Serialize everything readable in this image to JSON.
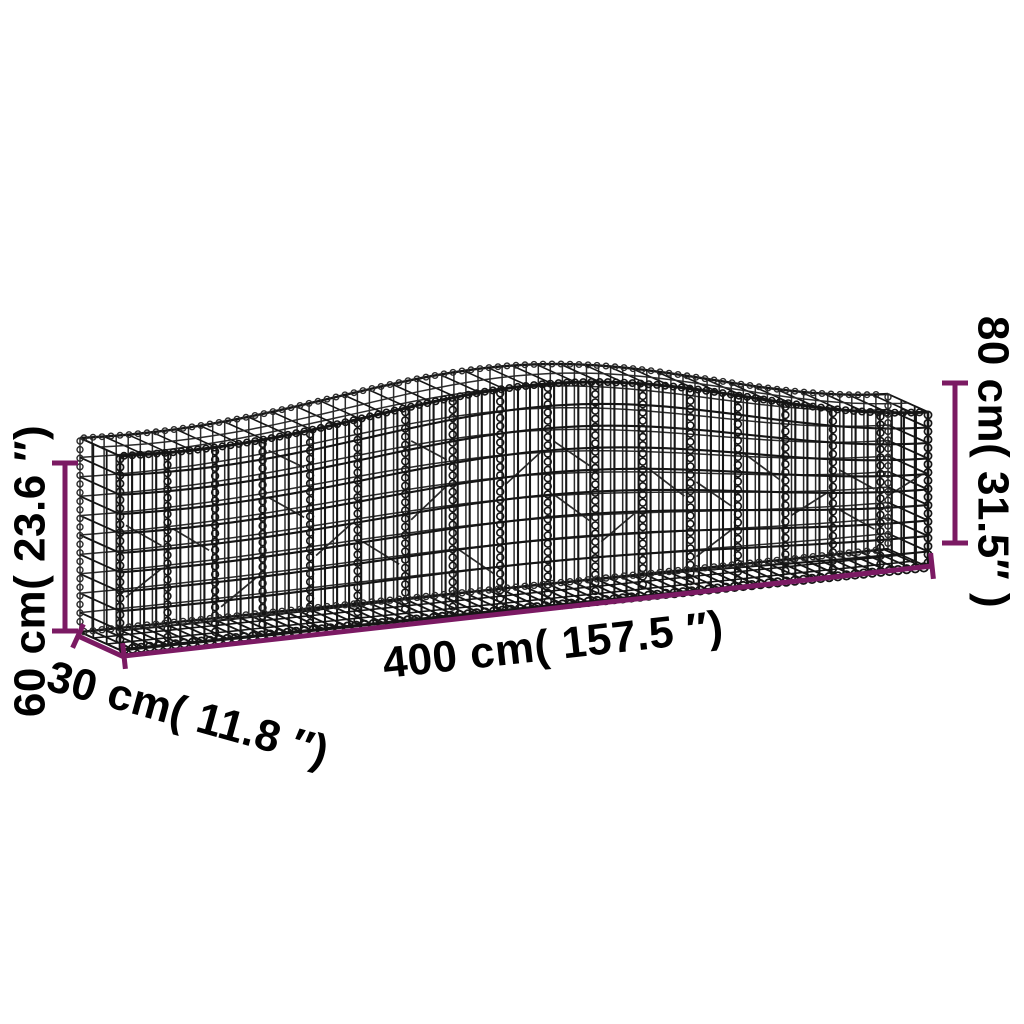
{
  "diagram": {
    "type": "product-dimension-diagram",
    "subject": "arched gabion wire mesh basket",
    "background_color": "#ffffff",
    "accent_color": "#7B1A63",
    "wire_color": "#151515",
    "wire_color_back": "#2b2b2b",
    "dimensions": {
      "length": {
        "label": "400 cm( 157.5 ″)",
        "cm": 400,
        "inches": 157.5
      },
      "depth": {
        "label": "30 cm( 11.8 ″)",
        "cm": 30,
        "inches": 11.8
      },
      "height_end": {
        "label": "60 cm( 23.6 ″)",
        "cm": 60,
        "inches": 23.6
      },
      "height_peak": {
        "label": "80 cm( 31.5″ )",
        "cm": 80,
        "inches": 31.5
      }
    }
  }
}
